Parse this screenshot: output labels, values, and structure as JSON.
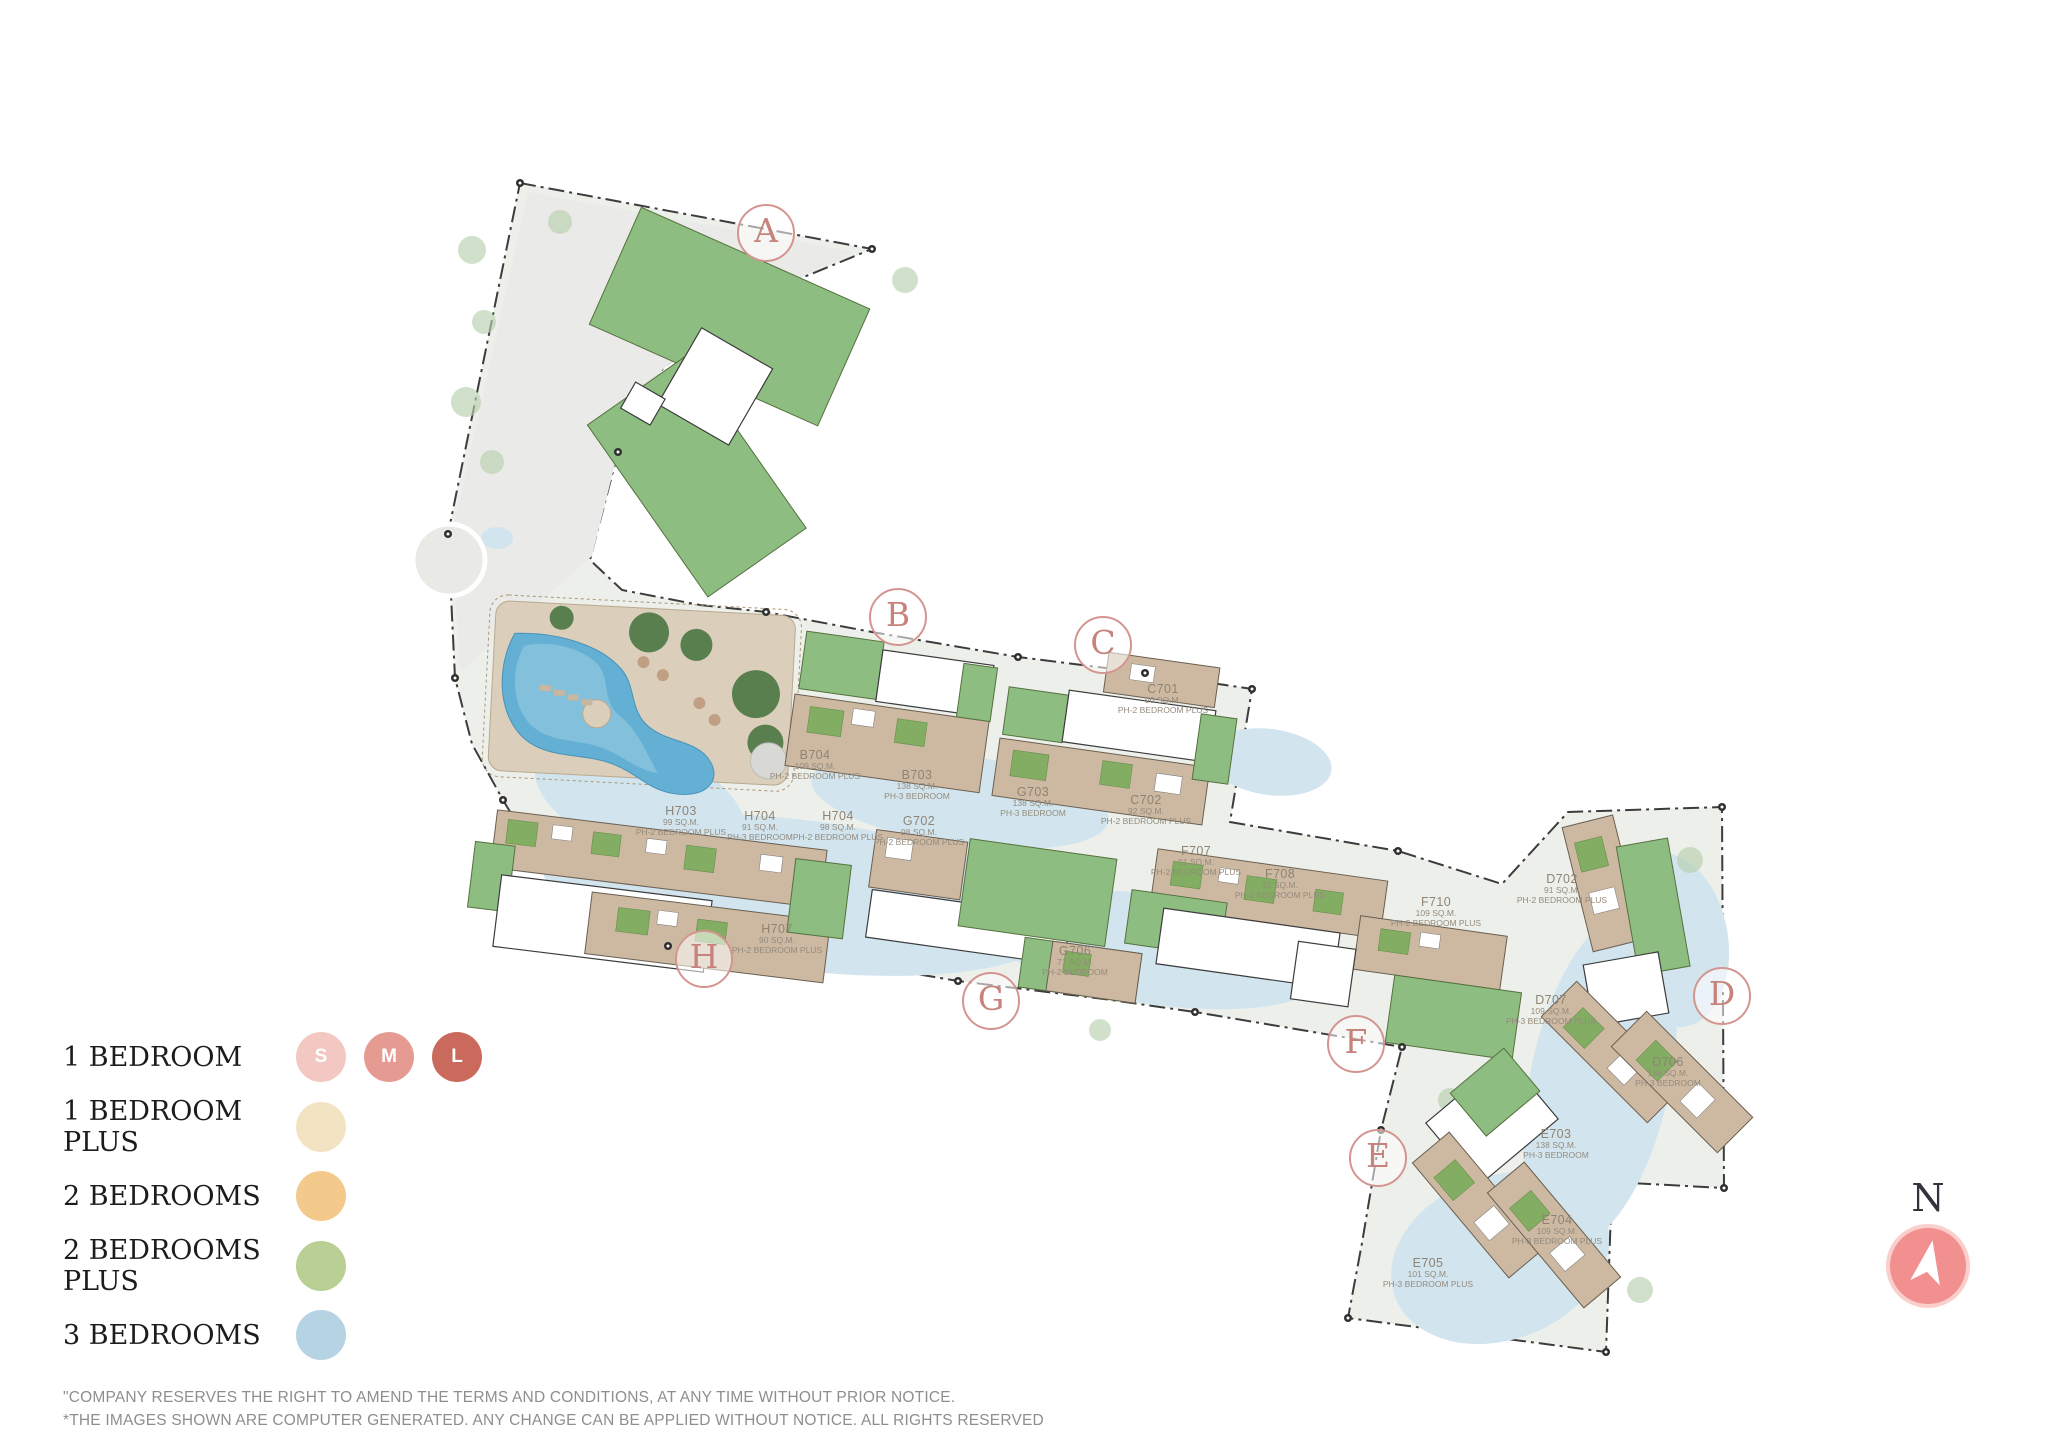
{
  "map": {
    "marker_color": "#d49590",
    "block_markers": [
      {
        "letter": "A",
        "x": 766,
        "y": 233
      },
      {
        "letter": "B",
        "x": 898,
        "y": 617
      },
      {
        "letter": "C",
        "x": 1103,
        "y": 645
      },
      {
        "letter": "D",
        "x": 1722,
        "y": 996
      },
      {
        "letter": "E",
        "x": 1378,
        "y": 1158
      },
      {
        "letter": "F",
        "x": 1356,
        "y": 1044
      },
      {
        "letter": "G",
        "x": 991,
        "y": 1001
      },
      {
        "letter": "H",
        "x": 704,
        "y": 959
      }
    ],
    "unit_labels": [
      {
        "code": "B704",
        "area": "109 SQ.M.",
        "type": "PH-2 BEDROOM PLUS",
        "x": 815,
        "y": 756
      },
      {
        "code": "B703",
        "area": "138 SQ.M.",
        "type": "PH-3 BEDROOM",
        "x": 917,
        "y": 776
      },
      {
        "code": "C701",
        "area": "90 SQ.M.",
        "type": "PH-2 BEDROOM PLUS",
        "x": 1163,
        "y": 690
      },
      {
        "code": "C702",
        "area": "92 SQ.M.",
        "type": "PH-2 BEDROOM PLUS",
        "x": 1146,
        "y": 801
      },
      {
        "code": "G703",
        "area": "138 SQ.M.",
        "type": "PH-3 BEDROOM",
        "x": 1033,
        "y": 793
      },
      {
        "code": "H703",
        "area": "99 SQ.M.",
        "type": "PH-2 BEDROOM PLUS",
        "x": 681,
        "y": 812
      },
      {
        "code": "H704",
        "area": "91 SQ.M.",
        "type": "PH-3 BEDROOM",
        "x": 760,
        "y": 817
      },
      {
        "code": "H704",
        "area": "98 SQ.M.",
        "type": "PH-2 BEDROOM PLUS",
        "x": 838,
        "y": 817
      },
      {
        "code": "G702",
        "area": "98 SQ.M.",
        "type": "PH-2 BEDROOM PLUS",
        "x": 919,
        "y": 822
      },
      {
        "code": "H707",
        "area": "90 SQ.M.",
        "type": "PH-2 BEDROOM PLUS",
        "x": 777,
        "y": 930
      },
      {
        "code": "G706",
        "area": "71 SQ.M.",
        "type": "PH-2 BEDROOM",
        "x": 1075,
        "y": 952
      },
      {
        "code": "F707",
        "area": "91 SQ.M.",
        "type": "PH-2 BEDROOM PLUS",
        "x": 1196,
        "y": 852
      },
      {
        "code": "F708",
        "area": "91 SQ.M.",
        "type": "PH-2 BEDROOM PLUS",
        "x": 1280,
        "y": 875
      },
      {
        "code": "F710",
        "area": "109 SQ.M.",
        "type": "PH-2 BEDROOM PLUS",
        "x": 1436,
        "y": 903
      },
      {
        "code": "D702",
        "area": "91 SQ.M.",
        "type": "PH-2 BEDROOM PLUS",
        "x": 1562,
        "y": 880
      },
      {
        "code": "D707",
        "area": "109 SQ.M.",
        "type": "PH-3 BEDROOM PLUS",
        "x": 1551,
        "y": 1001
      },
      {
        "code": "D706",
        "area": "138 SQ.M.",
        "type": "PH-3 BEDROOM",
        "x": 1668,
        "y": 1063
      },
      {
        "code": "E703",
        "area": "138 SQ.M.",
        "type": "PH-3 BEDROOM",
        "x": 1556,
        "y": 1135
      },
      {
        "code": "E704",
        "area": "109 SQ.M.",
        "type": "PH-3 BEDROOM PLUS",
        "x": 1557,
        "y": 1221
      },
      {
        "code": "E705",
        "area": "101 SQ.M.",
        "type": "PH-3 BEDROOM PLUS",
        "x": 1428,
        "y": 1264
      }
    ]
  },
  "legend": {
    "items": [
      {
        "label": "1 BEDROOM",
        "swatches": [
          {
            "text": "S",
            "color": "#f3c8c3"
          },
          {
            "text": "M",
            "color": "#e69b92"
          },
          {
            "text": "L",
            "color": "#c96a5c"
          }
        ]
      },
      {
        "label": "1 BEDROOM PLUS",
        "swatches": [
          {
            "text": "",
            "color": "#f2e3c3"
          }
        ]
      },
      {
        "label": "2 BEDROOMS",
        "swatches": [
          {
            "text": "",
            "color": "#f3ca8c"
          }
        ]
      },
      {
        "label": "2 BEDROOMS PLUS",
        "swatches": [
          {
            "text": "",
            "color": "#bacf93"
          }
        ]
      },
      {
        "label": "3 BEDROOMS",
        "swatches": [
          {
            "text": "",
            "color": "#b5d3e2"
          }
        ]
      }
    ]
  },
  "compass": {
    "label": "N",
    "color": "#f29090"
  },
  "disclaimer": {
    "line1": "\"COMPANY RESERVES THE RIGHT TO AMEND THE TERMS AND CONDITIONS, AT ANY TIME WITHOUT PRIOR NOTICE.",
    "line2": "*THE IMAGES SHOWN ARE COMPUTER GENERATED. ANY CHANGE CAN BE APPLIED WITHOUT NOTICE. ALL RIGHTS RESERVED"
  }
}
